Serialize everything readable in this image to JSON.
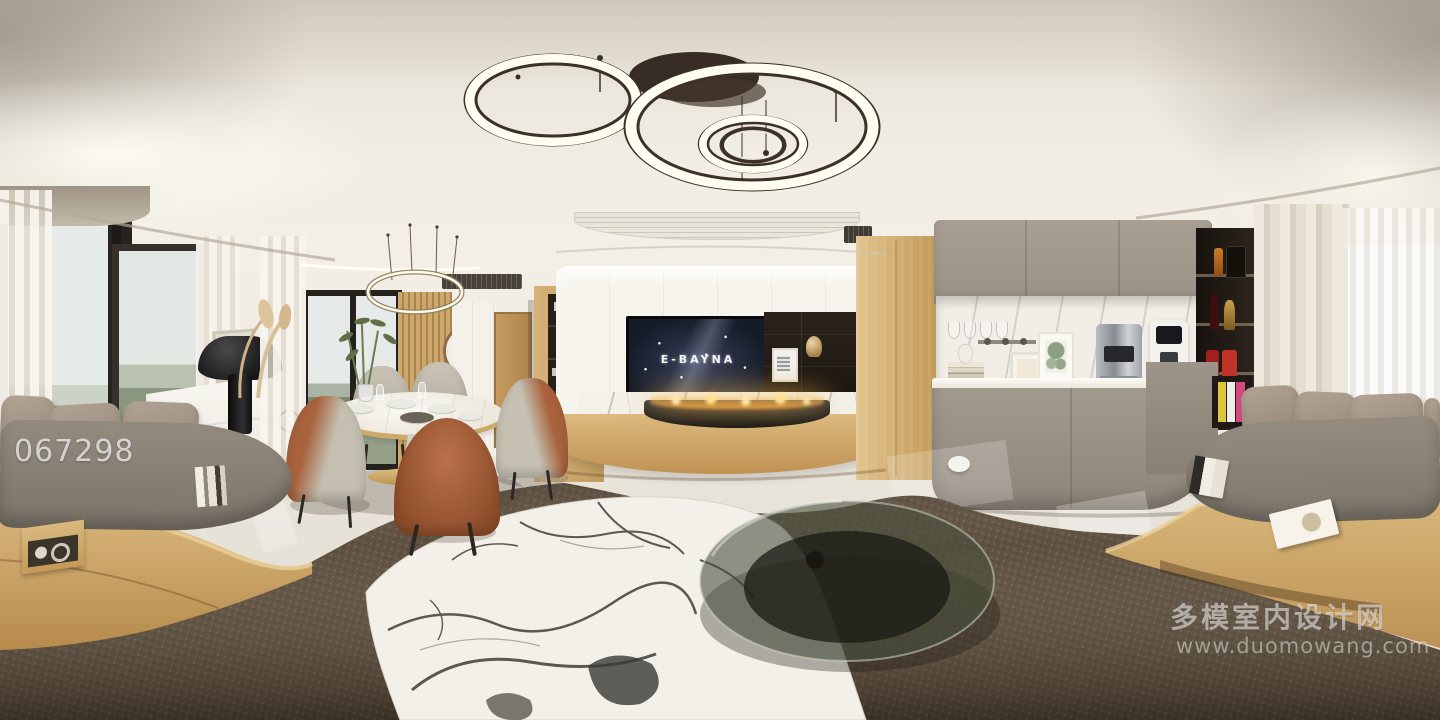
{
  "scene": {
    "description": "360-degree equirectangular panorama render of a modern living and dining room with TV wall, fireplace, dining set, coffee bar and window daybeds"
  },
  "watermarks": {
    "photo_id": "067298",
    "site_name": "多模室内设计网",
    "site_url": "www.duomowang.com"
  },
  "tv": {
    "screen_text": "E-BAYNA"
  },
  "palette": {
    "ceiling": "#f2eee5",
    "wall": "#f1ede5",
    "floor": "#e9e4da",
    "marble": "#f4f1ea",
    "wood": "#cda76c",
    "taupe": "#a89e93",
    "taupe_deep": "#8e857a",
    "niche_dark": "#281f17",
    "tv_screen": "#161b28",
    "rug": "#564838",
    "cushion": "#948b7f",
    "pillow": "#b2a494",
    "rust": "#a8623c",
    "chair_gray": "#c9c4b6",
    "glass": "#495040",
    "flame": "#eda43e",
    "gold": "#e0bf82",
    "curtain": "#efe9dd",
    "sky": "#e6eae8",
    "foliage": "#8d977f"
  }
}
